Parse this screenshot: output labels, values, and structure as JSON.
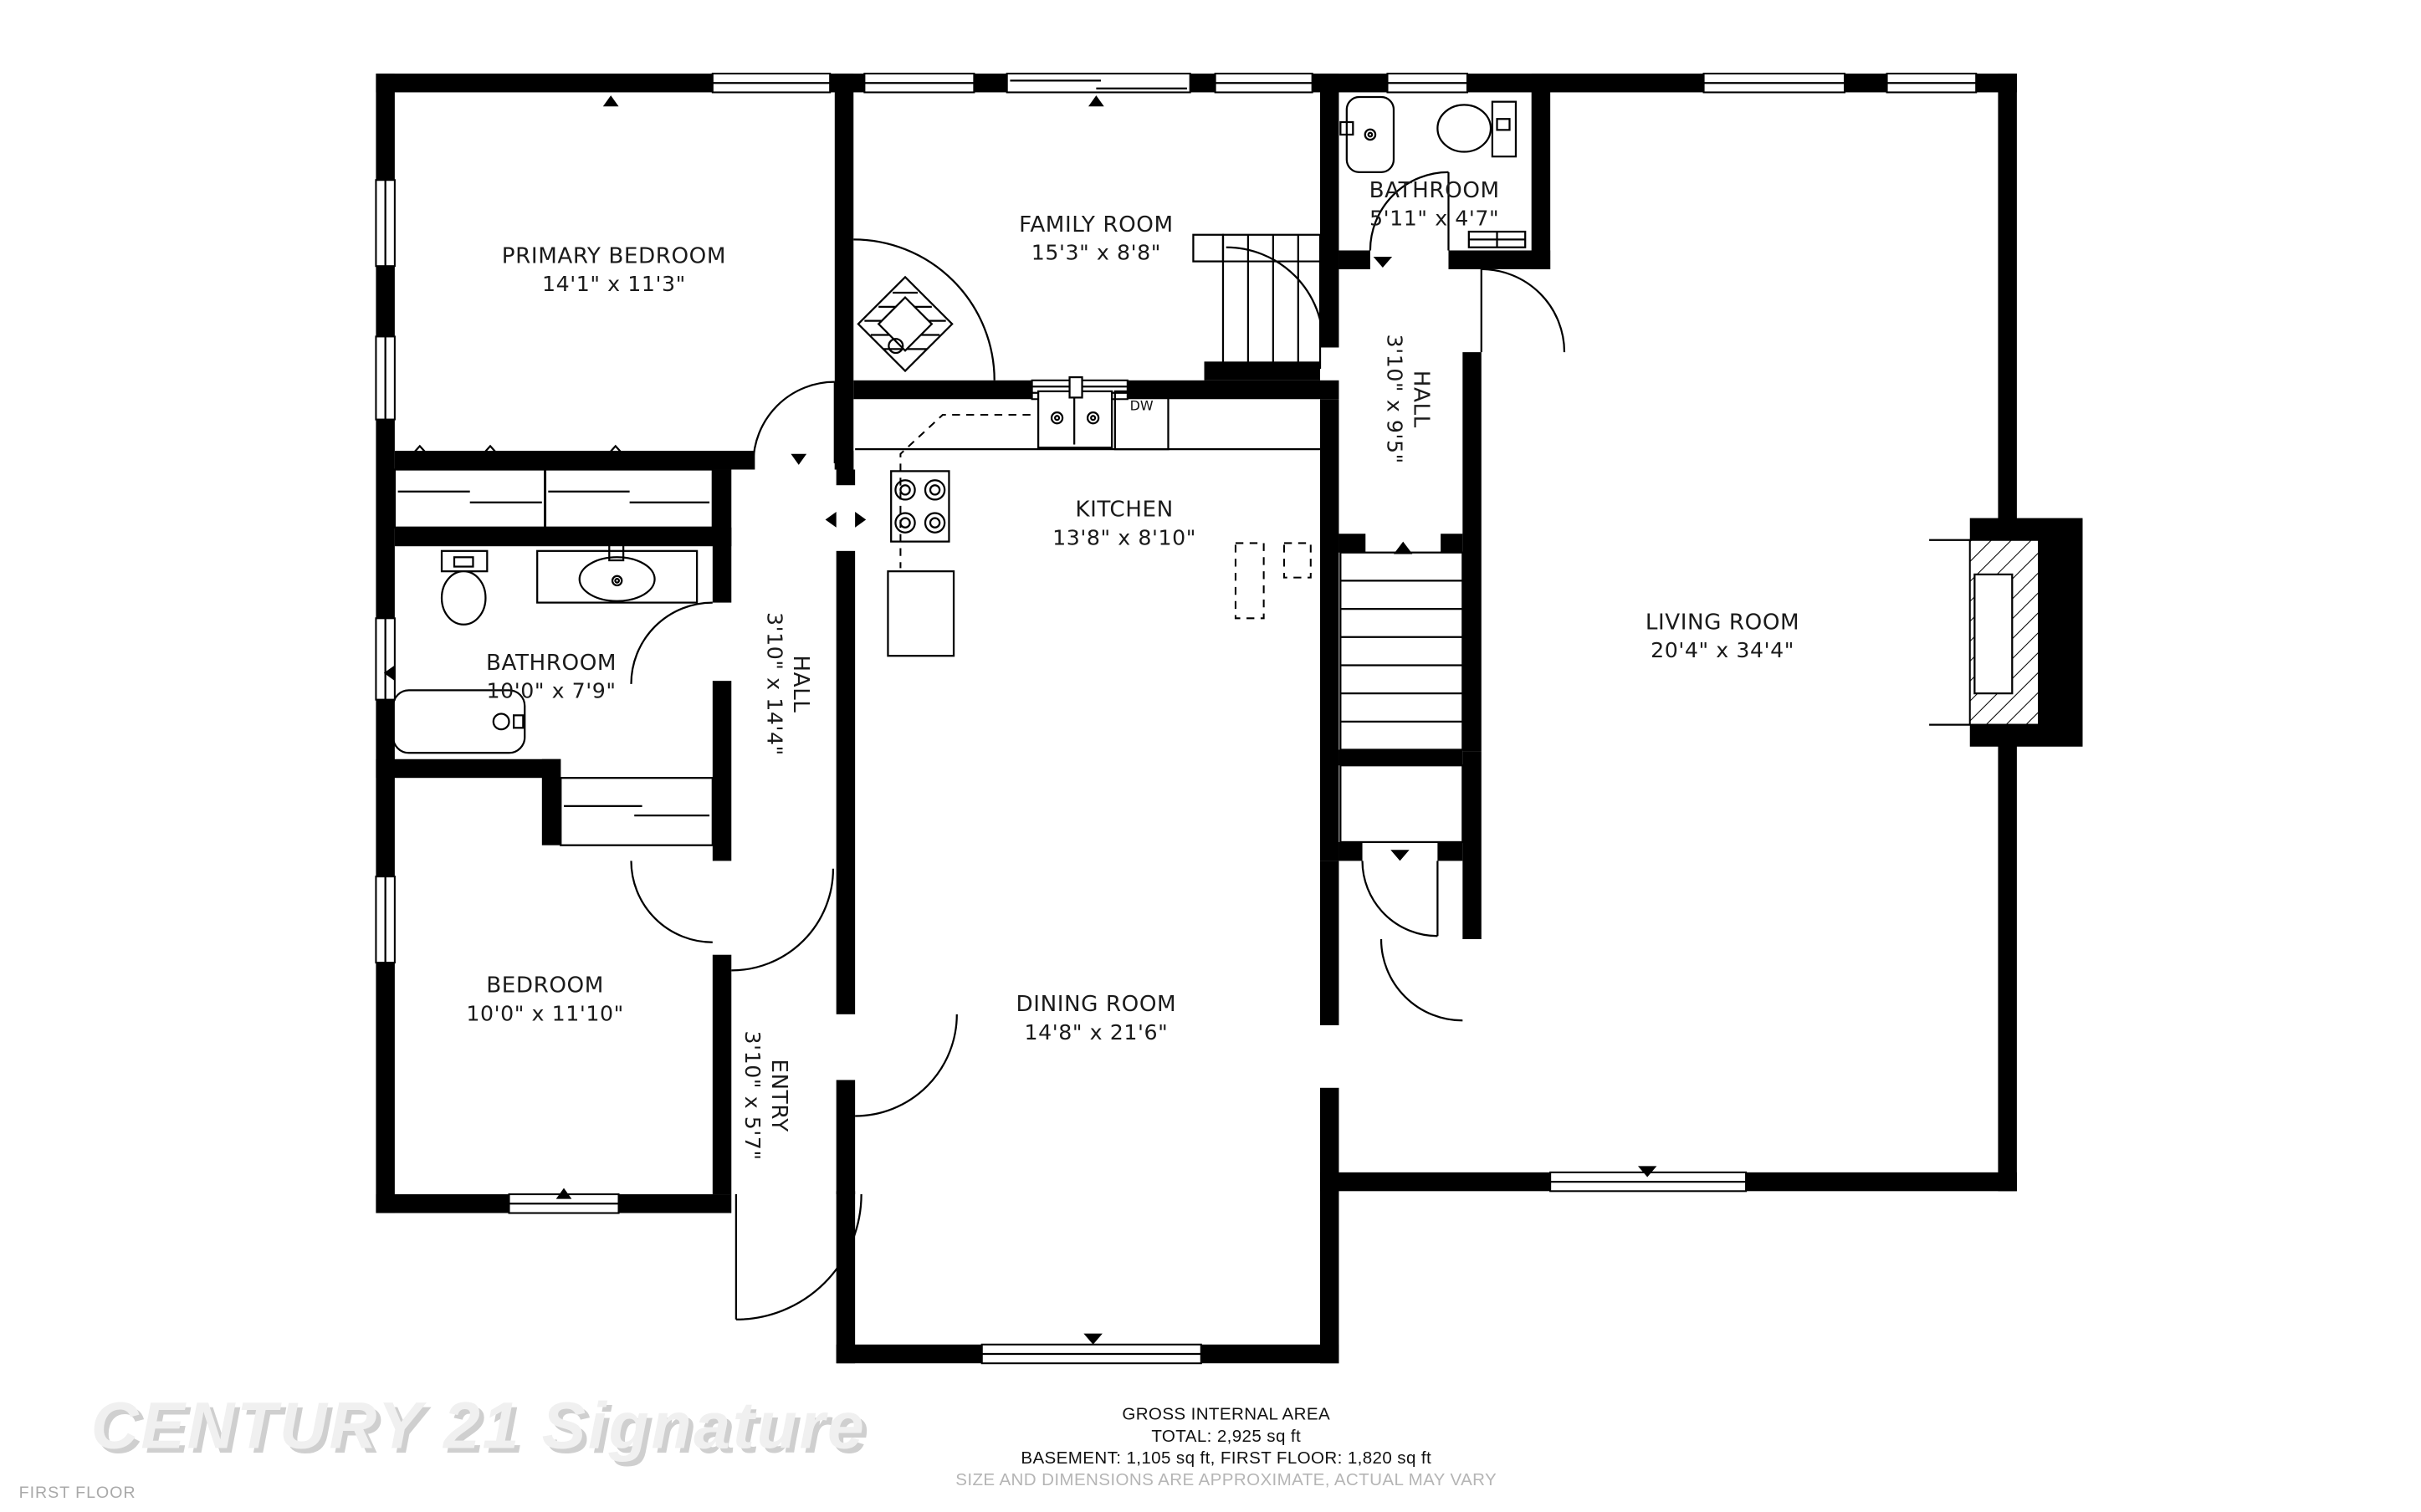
{
  "rooms": [
    {
      "name": "PRIMARY BEDROOM",
      "dims": "14'1\" x 11'3\""
    },
    {
      "name": "FAMILY ROOM",
      "dims": "15'3\" x 8'8\""
    },
    {
      "name": "BATHROOM",
      "dims": "5'11\" x 4'7\""
    },
    {
      "name": "HALL",
      "dims": "3'10\" x 9'5\""
    },
    {
      "name": "KITCHEN",
      "dims": "13'8\" x 8'10\""
    },
    {
      "name": "LIVING ROOM",
      "dims": "20'4\" x 34'4\""
    },
    {
      "name": "BATHROOM",
      "dims": "10'0\" x 7'9\""
    },
    {
      "name": "HALL",
      "dims": "3'10\" x 14'4\""
    },
    {
      "name": "BEDROOM",
      "dims": "10'0\" x 11'10\""
    },
    {
      "name": "ENTRY",
      "dims": "3'10\" x 5'7\""
    },
    {
      "name": "DINING ROOM",
      "dims": "14'8\" x 21'6\""
    }
  ],
  "kitchen": {
    "dishwasher_label": "DW"
  },
  "footer": {
    "title": "GROSS INTERNAL AREA",
    "total": "TOTAL: 2,925 sq ft",
    "breakdown": "BASEMENT: 1,105 sq ft, FIRST FLOOR: 1,820 sq ft",
    "disclaimer": "SIZE AND DIMENSIONS ARE APPROXIMATE, ACTUAL MAY VARY"
  },
  "watermark": "CENTURY 21 Signature",
  "floor_label": "FIRST FLOOR",
  "colors": {
    "walls": "#000000",
    "label_text": "#1a1a1a",
    "disclaimer_text": "#b5b5b5",
    "watermark_text": "#f0f0f0",
    "floor_label_text": "#a9a9a9",
    "background": "#ffffff"
  }
}
